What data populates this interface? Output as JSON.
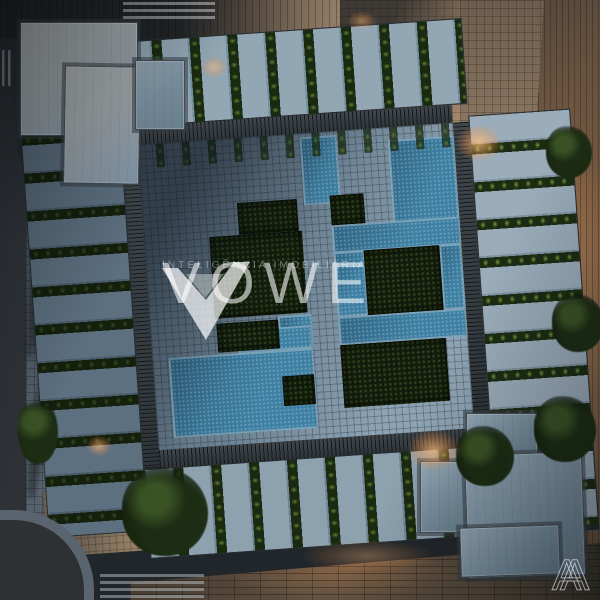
{
  "watermark": {
    "brand": "VOWE",
    "tagline": "INTELIGÊNCIA IMOBILIÁRIA",
    "logo": "vowe-chevron-logo"
  },
  "corner_mark": {
    "letter": "A"
  },
  "palette": {
    "asphalt": "#2f3336",
    "sidewalk": "#4d5862",
    "plaza_tan": "#bda183",
    "paving_shadow": "#5e7181",
    "paving_light": "#8da2b2",
    "water": "#3e80a3",
    "planting_dark": "#131c0c",
    "hedge": "#1a2a10",
    "hedge_highlight": "#6f9a40",
    "terrace_floor": "#92a6b4",
    "roof_light": "#abb1b3",
    "roof_blue": "#7e93a4",
    "wood_deck": "#9a7350",
    "boardwalk": "#544739",
    "lamp_glow": "#ffb271"
  },
  "scene": {
    "description": "dusk aerial top view of residential block with central pool courtyard",
    "courtyard": {
      "blocks": [
        {
          "type": "water",
          "x": 51.4,
          "y": 1.4,
          "w": 11.5,
          "h": 22.2
        },
        {
          "type": "water",
          "x": 79.2,
          "y": 4.1,
          "w": 20.8,
          "h": 30.3
        },
        {
          "type": "water",
          "x": 59.6,
          "y": 30.8,
          "w": 40.4,
          "h": 9.2
        },
        {
          "type": "water",
          "x": 59.6,
          "y": 39.7,
          "w": 9.6,
          "h": 21.1
        },
        {
          "type": "water",
          "x": 92.9,
          "y": 39.7,
          "w": 7.1,
          "h": 21.1
        },
        {
          "type": "water",
          "x": 59.6,
          "y": 60.8,
          "w": 40.4,
          "h": 9.2
        },
        {
          "type": "water",
          "x": 40.4,
          "y": 59.2,
          "w": 10.9,
          "h": 11.1
        },
        {
          "type": "water",
          "x": 27.3,
          "y": 62.7,
          "w": 23.8,
          "h": 7.6
        },
        {
          "type": "water",
          "x": 5.0,
          "y": 70.3,
          "w": 46.0,
          "h": 26.2
        },
        {
          "type": "green",
          "x": 30.1,
          "y": 21.4,
          "w": 19.1,
          "h": 10.3
        },
        {
          "type": "green",
          "x": 20.5,
          "y": 31.6,
          "w": 29.5,
          "h": 27.0
        },
        {
          "type": "green",
          "x": 59.6,
          "y": 20.8,
          "w": 10.7,
          "h": 10.0
        },
        {
          "type": "green",
          "x": 69.1,
          "y": 39.7,
          "w": 23.8,
          "h": 21.1
        },
        {
          "type": "green",
          "x": 21.0,
          "y": 60.0,
          "w": 19.4,
          "h": 9.7
        },
        {
          "type": "green",
          "x": 40.4,
          "y": 78.9,
          "w": 10.1,
          "h": 9.7
        },
        {
          "type": "green",
          "x": 59.6,
          "y": 70.0,
          "w": 33.3,
          "h": 20.5
        }
      ]
    }
  }
}
